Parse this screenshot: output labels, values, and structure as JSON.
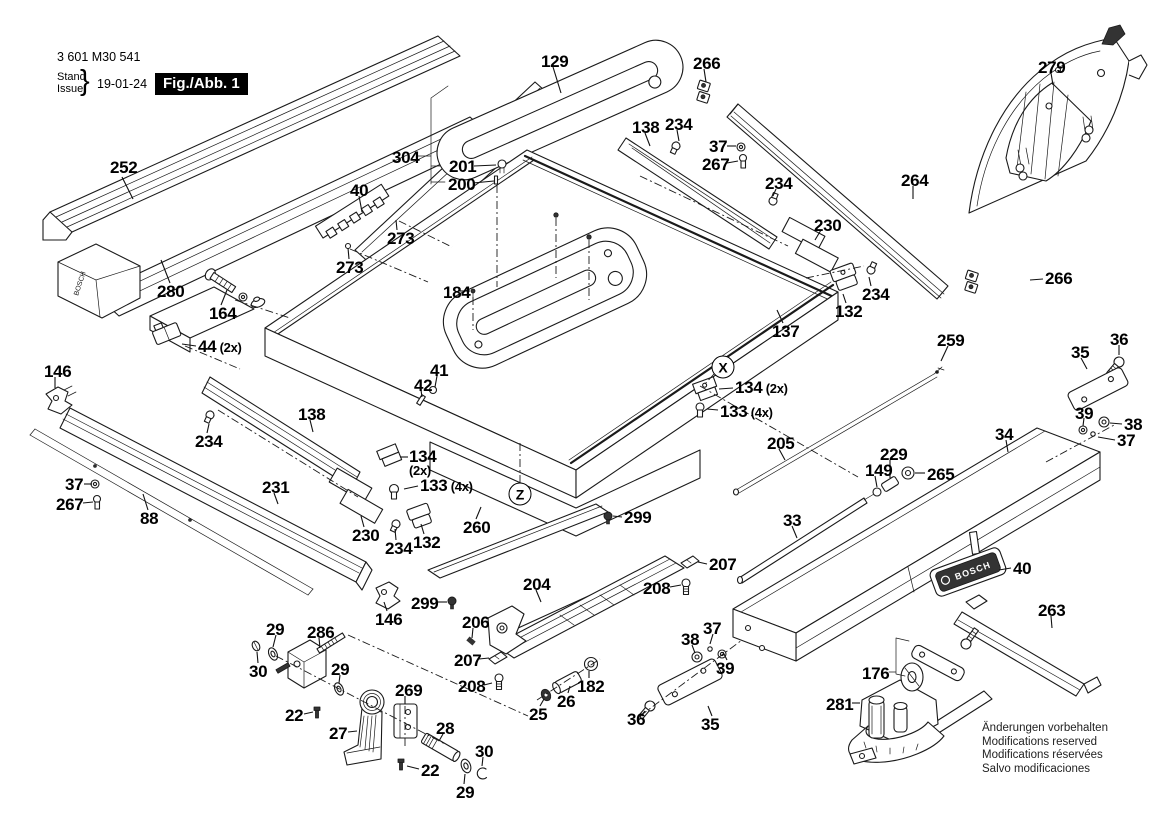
{
  "header": {
    "part_number": "3 601 M30 541",
    "stand_label": "Stand",
    "issue_label": "Issue",
    "date": "19-01-24",
    "figure_label": "Fig./Abb. 1"
  },
  "brand": {
    "logo_text": "BOSCH"
  },
  "footer_notes": [
    "Änderungen vorbehalten",
    "Modifications reserved",
    "Modifications réservées",
    "Salvo modificaciones"
  ],
  "detail_markers": [
    {
      "label": "X",
      "cx": 723,
      "cy": 367
    },
    {
      "label": "Z",
      "cx": 520,
      "cy": 494
    }
  ],
  "part_labels": [
    {
      "t": "252",
      "x": 110,
      "y": 160,
      "l": [
        122,
        177,
        133,
        199
      ]
    },
    {
      "t": "40",
      "x": 350,
      "y": 183,
      "l": [
        359,
        196,
        362,
        212
      ]
    },
    {
      "t": "273",
      "x": 387,
      "y": 231,
      "l": [
        397,
        230,
        396,
        220
      ]
    },
    {
      "t": "273",
      "x": 336,
      "y": 260,
      "l": [
        349,
        259,
        348,
        248
      ]
    },
    {
      "t": "280",
      "x": 157,
      "y": 284,
      "l": [
        170,
        283,
        161,
        260
      ]
    },
    {
      "t": "164",
      "x": 209,
      "y": 306,
      "l": [
        221,
        305,
        227,
        290
      ]
    },
    {
      "t": "44",
      "s": "(2x)",
      "x": 198,
      "y": 339,
      "l": [
        196,
        346,
        182,
        344
      ]
    },
    {
      "t": "146",
      "x": 44,
      "y": 364,
      "l": [
        55,
        377,
        55,
        388
      ]
    },
    {
      "t": "138",
      "x": 298,
      "y": 407,
      "l": [
        310,
        420,
        313,
        432
      ]
    },
    {
      "t": "234",
      "x": 195,
      "y": 434,
      "l": [
        207,
        433,
        209,
        424
      ]
    },
    {
      "t": "37",
      "x": 65,
      "y": 477,
      "l": [
        84,
        484,
        92,
        484
      ]
    },
    {
      "t": "267",
      "x": 56,
      "y": 497,
      "l": [
        83,
        503,
        93,
        502
      ]
    },
    {
      "t": "88",
      "x": 140,
      "y": 511,
      "l": [
        148,
        510,
        143,
        494
      ]
    },
    {
      "t": "231",
      "x": 262,
      "y": 480,
      "l": [
        274,
        493,
        278,
        504
      ]
    },
    {
      "t": "230",
      "x": 352,
      "y": 528,
      "l": [
        364,
        527,
        361,
        516
      ]
    },
    {
      "t": "234",
      "x": 385,
      "y": 541,
      "l": [
        396,
        540,
        395,
        529
      ]
    },
    {
      "t": "134",
      "s": "(2x)",
      "stack": true,
      "x": 409,
      "y": 449,
      "l": [
        408,
        457,
        400,
        457
      ]
    },
    {
      "t": "133",
      "s": "(4x)",
      "x": 420,
      "y": 478,
      "l": [
        418,
        486,
        404,
        489
      ]
    },
    {
      "t": "132",
      "x": 413,
      "y": 535,
      "l": [
        424,
        534,
        421,
        524
      ]
    },
    {
      "t": "260",
      "x": 463,
      "y": 520,
      "l": [
        476,
        519,
        481,
        507
      ]
    },
    {
      "t": "299",
      "x": 411,
      "y": 596,
      "l": [
        437,
        602,
        447,
        602
      ]
    },
    {
      "t": "146",
      "x": 375,
      "y": 612,
      "l": [
        387,
        611,
        384,
        602
      ]
    },
    {
      "t": "204",
      "x": 523,
      "y": 577,
      "l": [
        536,
        590,
        541,
        602
      ]
    },
    {
      "t": "206",
      "x": 462,
      "y": 615,
      "l": [
        473,
        628,
        472,
        638
      ]
    },
    {
      "t": "207",
      "x": 454,
      "y": 653,
      "l": [
        479,
        659,
        489,
        658
      ]
    },
    {
      "t": "208",
      "x": 458,
      "y": 679,
      "l": [
        484,
        685,
        492,
        683
      ]
    },
    {
      "t": "299",
      "x": 624,
      "y": 510,
      "l": [
        622,
        517,
        613,
        516
      ]
    },
    {
      "t": "41",
      "x": 430,
      "y": 363,
      "l": [
        437,
        376,
        435,
        387
      ]
    },
    {
      "t": "42",
      "x": 414,
      "y": 378,
      "l": [
        421,
        390,
        422,
        397
      ]
    },
    {
      "t": "184",
      "x": 443,
      "y": 285,
      "l": [
        458,
        291,
        470,
        291
      ]
    },
    {
      "t": "304",
      "x": 392,
      "y": 150
    },
    {
      "t": "201",
      "x": 449,
      "y": 159,
      "l": [
        474,
        166,
        496,
        165
      ]
    },
    {
      "t": "200",
      "x": 448,
      "y": 177,
      "l": [
        473,
        183,
        494,
        181
      ]
    },
    {
      "t": "129",
      "x": 541,
      "y": 54,
      "l": [
        553,
        67,
        561,
        93
      ]
    },
    {
      "t": "266",
      "x": 693,
      "y": 56,
      "l": [
        704,
        69,
        706,
        82
      ]
    },
    {
      "t": "138",
      "x": 632,
      "y": 120,
      "l": [
        645,
        133,
        650,
        146
      ]
    },
    {
      "t": "234",
      "x": 665,
      "y": 117,
      "l": [
        677,
        130,
        679,
        141
      ]
    },
    {
      "t": "37",
      "x": 709,
      "y": 139,
      "l": [
        727,
        146,
        736,
        146
      ]
    },
    {
      "t": "267",
      "x": 702,
      "y": 157,
      "l": [
        727,
        163,
        738,
        161
      ]
    },
    {
      "t": "234",
      "x": 765,
      "y": 176,
      "l": [
        776,
        189,
        773,
        196
      ]
    },
    {
      "t": "264",
      "x": 901,
      "y": 173,
      "l": [
        913,
        186,
        913,
        199
      ]
    },
    {
      "t": "279",
      "x": 1038,
      "y": 60,
      "l": [
        1051,
        73,
        1053,
        85
      ]
    },
    {
      "t": "230",
      "x": 814,
      "y": 218,
      "l": [
        821,
        230,
        815,
        240
      ]
    },
    {
      "t": "234",
      "x": 862,
      "y": 287,
      "l": [
        871,
        286,
        869,
        277
      ]
    },
    {
      "t": "132",
      "x": 835,
      "y": 304,
      "l": [
        846,
        303,
        843,
        294
      ]
    },
    {
      "t": "137",
      "x": 772,
      "y": 324,
      "l": [
        783,
        323,
        777,
        310
      ]
    },
    {
      "t": "134",
      "s": "(2x)",
      "x": 735,
      "y": 380,
      "l": [
        733,
        388,
        719,
        389
      ]
    },
    {
      "t": "133",
      "s": "(4x)",
      "x": 720,
      "y": 404,
      "l": [
        718,
        410,
        707,
        409
      ]
    },
    {
      "t": "266",
      "x": 1045,
      "y": 271,
      "l": [
        1043,
        279,
        1030,
        280
      ]
    },
    {
      "t": "259",
      "x": 937,
      "y": 333,
      "l": [
        948,
        346,
        941,
        361
      ]
    },
    {
      "t": "36",
      "x": 1110,
      "y": 332,
      "l": [
        1119,
        345,
        1119,
        355
      ]
    },
    {
      "t": "35",
      "x": 1071,
      "y": 345,
      "l": [
        1081,
        358,
        1087,
        369
      ]
    },
    {
      "t": "39",
      "x": 1075,
      "y": 406,
      "l": [
        1084,
        418,
        1083,
        426
      ]
    },
    {
      "t": "38",
      "x": 1124,
      "y": 417,
      "l": [
        1122,
        424,
        1110,
        423
      ]
    },
    {
      "t": "37",
      "x": 1117,
      "y": 433,
      "l": [
        1115,
        440,
        1098,
        437
      ]
    },
    {
      "t": "34",
      "x": 995,
      "y": 427,
      "l": [
        1006,
        440,
        1008,
        452
      ]
    },
    {
      "t": "205",
      "x": 767,
      "y": 436,
      "l": [
        779,
        449,
        785,
        460
      ]
    },
    {
      "t": "229",
      "x": 880,
      "y": 447,
      "l": [
        890,
        460,
        890,
        478
      ]
    },
    {
      "t": "149",
      "x": 865,
      "y": 463,
      "l": [
        875,
        476,
        877,
        487
      ]
    },
    {
      "t": "265",
      "x": 927,
      "y": 467,
      "l": [
        925,
        473,
        915,
        473
      ]
    },
    {
      "t": "33",
      "x": 783,
      "y": 513,
      "l": [
        792,
        526,
        797,
        538
      ]
    },
    {
      "t": "29",
      "x": 266,
      "y": 622,
      "l": [
        276,
        635,
        273,
        647
      ]
    },
    {
      "t": "286",
      "x": 307,
      "y": 625,
      "l": [
        319,
        638,
        320,
        648
      ]
    },
    {
      "t": "30",
      "x": 249,
      "y": 664,
      "l": [
        258,
        663,
        257,
        652
      ]
    },
    {
      "t": "29",
      "x": 331,
      "y": 662,
      "l": [
        340,
        675,
        339,
        683
      ]
    },
    {
      "t": "22",
      "x": 285,
      "y": 708,
      "l": [
        304,
        714,
        313,
        712
      ]
    },
    {
      "t": "27",
      "x": 329,
      "y": 726,
      "l": [
        348,
        732,
        357,
        731
      ]
    },
    {
      "t": "269",
      "x": 395,
      "y": 683,
      "l": [
        405,
        696,
        405,
        704
      ]
    },
    {
      "t": "28",
      "x": 436,
      "y": 721,
      "l": [
        443,
        734,
        439,
        741
      ]
    },
    {
      "t": "30",
      "x": 475,
      "y": 744,
      "l": [
        483,
        757,
        482,
        766
      ]
    },
    {
      "t": "22",
      "x": 421,
      "y": 763,
      "l": [
        419,
        769,
        407,
        766
      ]
    },
    {
      "t": "29",
      "x": 456,
      "y": 785,
      "l": [
        464,
        784,
        465,
        774
      ]
    },
    {
      "t": "25",
      "x": 529,
      "y": 707,
      "l": [
        540,
        706,
        544,
        699
      ]
    },
    {
      "t": "26",
      "x": 557,
      "y": 694,
      "l": [
        568,
        693,
        570,
        686
      ]
    },
    {
      "t": "182",
      "x": 577,
      "y": 679,
      "l": [
        589,
        678,
        589,
        671
      ]
    },
    {
      "t": "36",
      "x": 627,
      "y": 712,
      "l": [
        640,
        717,
        645,
        711
      ]
    },
    {
      "t": "35",
      "x": 701,
      "y": 717,
      "l": [
        712,
        716,
        708,
        706
      ]
    },
    {
      "t": "38",
      "x": 681,
      "y": 632,
      "l": [
        692,
        645,
        695,
        653
      ]
    },
    {
      "t": "37",
      "x": 703,
      "y": 621,
      "l": [
        713,
        634,
        710,
        644
      ]
    },
    {
      "t": "39",
      "x": 716,
      "y": 661,
      "l": [
        727,
        660,
        723,
        652
      ]
    },
    {
      "t": "207",
      "x": 709,
      "y": 557,
      "l": [
        707,
        564,
        698,
        562
      ]
    },
    {
      "t": "208",
      "x": 643,
      "y": 581,
      "l": [
        670,
        587,
        681,
        585
      ]
    },
    {
      "t": "40",
      "x": 1013,
      "y": 561,
      "l": [
        1011,
        568,
        999,
        570
      ]
    },
    {
      "t": "263",
      "x": 1038,
      "y": 603,
      "l": [
        1051,
        616,
        1052,
        628
      ]
    },
    {
      "t": "176",
      "x": 862,
      "y": 666
    },
    {
      "t": "281",
      "x": 826,
      "y": 697,
      "l": [
        852,
        703,
        860,
        703
      ]
    }
  ]
}
